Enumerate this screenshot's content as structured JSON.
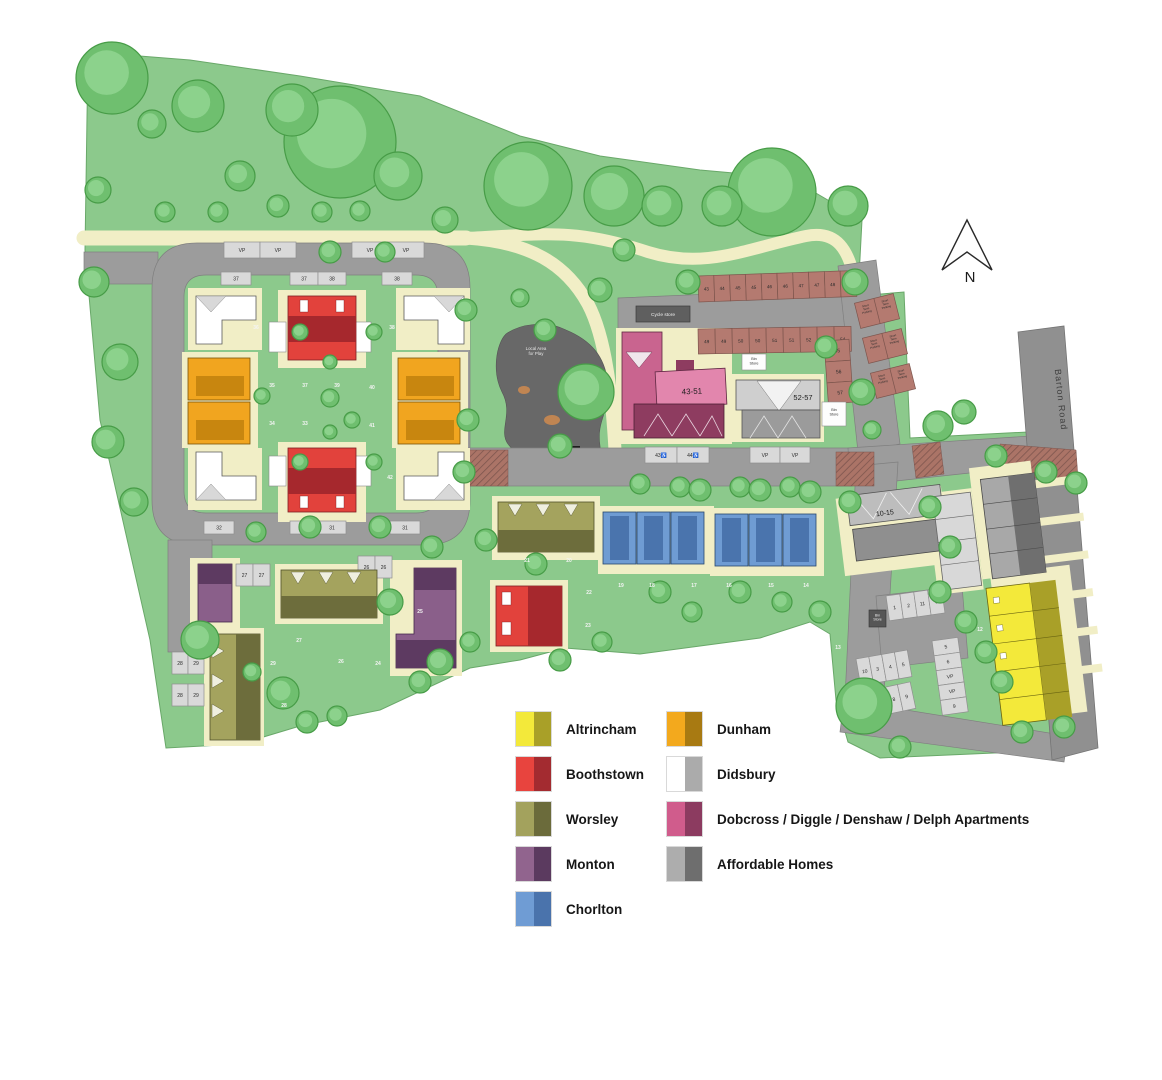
{
  "legend": {
    "items": [
      {
        "label": "Altrincham",
        "color_light": "#f3e93a",
        "color_dark": "#a9a028"
      },
      {
        "label": "Boothstown",
        "color_light": "#e8443e",
        "color_dark": "#a32b30"
      },
      {
        "label": "Worsley",
        "color_light": "#a3a25d",
        "color_dark": "#6b6b3b"
      },
      {
        "label": "Monton",
        "color_light": "#91648e",
        "color_dark": "#5b3a5f"
      },
      {
        "label": "Chorlton",
        "color_light": "#6f9cd4",
        "color_dark": "#4a73ac"
      },
      {
        "label": "Dunham",
        "color_light": "#f3a91d",
        "color_dark": "#a87a12"
      },
      {
        "label": "Didsbury",
        "color_light": "#ffffff",
        "color_dark": "#ababab"
      },
      {
        "label": "Dobcross / Diggle / Denshaw / Delph Apartments",
        "color_light": "#d05c8c",
        "color_dark": "#8c3b60"
      },
      {
        "label": "Affordable Homes",
        "color_light": "#adadad",
        "color_dark": "#6e6e6e"
      }
    ]
  },
  "map": {
    "labels": {
      "apartments_a": "43-51",
      "apartments_b": "52-57",
      "apartments_c": "10-15",
      "barton_road": "Barton Road",
      "play_area": "Local Area for Play",
      "cycle_store": "Cycle store",
      "bin_store": "Bin Store",
      "short_term": "Short Term Parking",
      "north": "N",
      "vp": "VP"
    },
    "parking": {
      "loop_vp_a": [
        "VP",
        "VP"
      ],
      "loop_vp_b": [
        "VP",
        "VP"
      ],
      "loop_top_a": [
        "37"
      ],
      "loop_top_b": [
        "37",
        "38"
      ],
      "loop_top_c": [
        "38"
      ],
      "loop_bottom_a": [
        "32"
      ],
      "loop_bottom_b": [
        "32",
        "31"
      ],
      "loop_bottom_c": [
        "31"
      ],
      "sw_27": [
        "27",
        "27"
      ],
      "sw_26": [
        "26",
        "26"
      ],
      "sw_25": [
        "25",
        "25"
      ],
      "sw_24": [
        "24",
        "24"
      ],
      "sw_28a": [
        "28",
        "29"
      ],
      "sw_28b": [
        "28",
        "29"
      ],
      "apt_row1": [
        "43",
        "44",
        "45",
        "45",
        "46",
        "46",
        "47",
        "47",
        "48",
        "48"
      ],
      "apt_row2": [
        "49",
        "49",
        "50",
        "50",
        "51",
        "51",
        "52",
        "53",
        "54"
      ],
      "apt_disabled": [
        "43♿",
        "44♿"
      ],
      "apt_vp": [
        "VP",
        "VP"
      ],
      "barton_bays": [
        "55",
        "56",
        "57"
      ],
      "east_row1": [
        "1",
        "2",
        "11",
        "6"
      ],
      "east_row2": [
        "10",
        "3",
        "4",
        "5"
      ],
      "east_row3": [
        "7",
        "8",
        "9"
      ],
      "east_col": [
        "5",
        "6",
        "VP",
        "VP",
        "9"
      ]
    },
    "plots": {
      "nw": [
        "36",
        "38",
        "35",
        "37",
        "39",
        "40",
        "34",
        "33",
        "41",
        "42"
      ],
      "sw": [
        "27",
        "29",
        "26",
        "25",
        "24",
        "28"
      ],
      "central": [
        "21",
        "20",
        "22",
        "23"
      ],
      "terrace": [
        "19",
        "18",
        "17",
        "16",
        "15",
        "14"
      ],
      "east": [
        "12",
        "13"
      ]
    }
  }
}
